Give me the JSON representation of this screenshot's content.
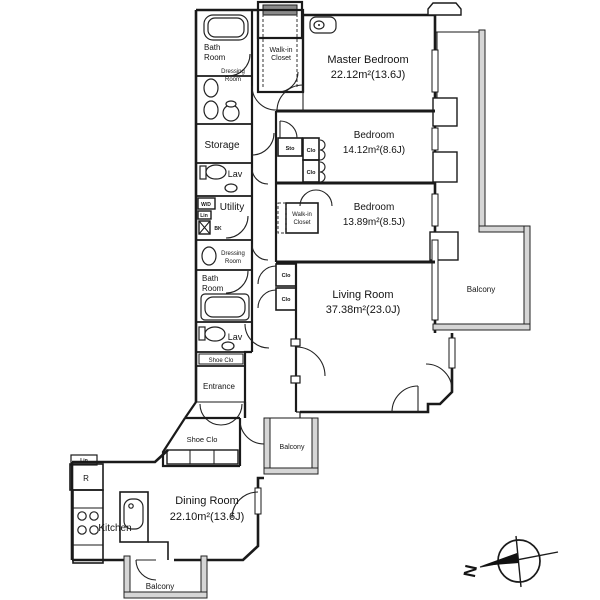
{
  "labels": {
    "master_bedroom": "Master Bedroom",
    "master_bedroom_area": "22.12m²(13.6J)",
    "bedroom": "Bedroom",
    "bedroom_mid_area": "14.12m²(8.6J)",
    "bedroom_low_area": "13.89m²(8.5J)",
    "living_room": "Living Room",
    "living_room_area": "37.38m²(23.0J)",
    "dining_room": "Dining Room",
    "dining_room_area": "22.10m²(13.6J)",
    "kitchen": "Kitchen",
    "bath": "Bath",
    "room": "Room",
    "dressing": "Dressing",
    "storage": "Storage",
    "lav": "Lav",
    "utility": "Utility",
    "wd": "W/D",
    "lin": "Lin",
    "bk": "BK",
    "shoe_clo": "Shoe Clo",
    "entrance": "Entrance",
    "walk_in": "Walk-in",
    "closet": "Closet",
    "sto": "Sto",
    "clo": "Clo",
    "balcony": "Balcony",
    "refrigerator": "R",
    "north": "N"
  },
  "colors": {
    "line": "#1a1a1a",
    "wall_fill": "#d6d6d6",
    "background": "#ffffff"
  }
}
